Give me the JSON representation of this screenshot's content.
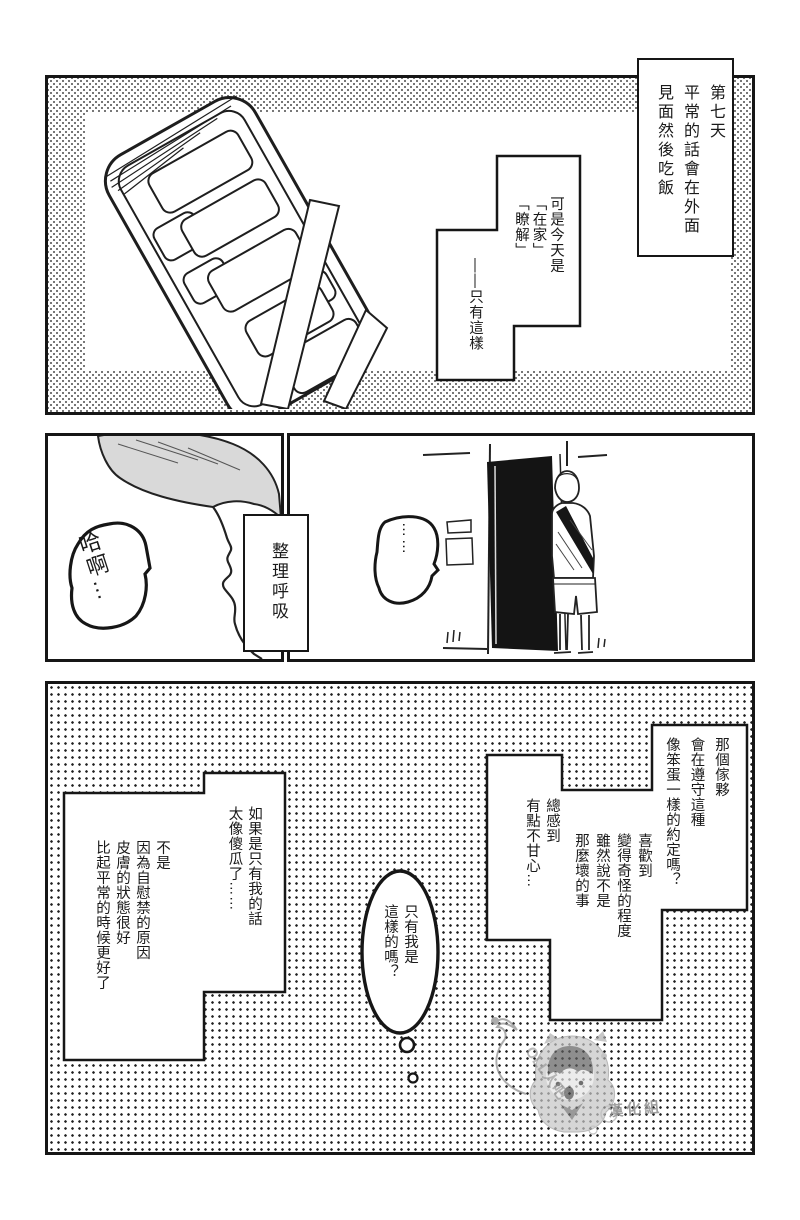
{
  "panel1": {
    "narration": [
      "第七天",
      "平常的話會在外面",
      "見面然後吃飯"
    ],
    "caption": [
      "可是今天是",
      "「在家」",
      "「瞭解」"
    ],
    "caption_tail": "——只有這樣"
  },
  "panel2": {
    "caption": "整理呼吸",
    "gasp": "哈啊…",
    "silence": "……"
  },
  "panel3": {
    "monologue_promise": [
      "那個傢夥",
      "會在遵守這種",
      "像笨蛋一樣的約定嗎？"
    ],
    "monologue_like": [
      "喜歡到",
      "變得奇怪的程度",
      "雖然說不是",
      "那麼壞的事"
    ],
    "monologue_vexed": [
      "總感到",
      "有點不甘心…"
    ],
    "monologue_fool": [
      "如果是只有我的話",
      "太像傻瓜了……"
    ],
    "monologue_skin": [
      "不是",
      "因為自慰禁的原因",
      "皮膚的狀態很好",
      "比起平常的時候更好了"
    ],
    "thought": [
      "只有我是",
      "這樣的嗎？"
    ],
    "watermark_side": "OLL人吧",
    "watermark_bottom": "漢化組"
  },
  "colors": {
    "ink": "#161616",
    "paper": "#ffffff",
    "hair_tone": "#d9d9d9"
  }
}
